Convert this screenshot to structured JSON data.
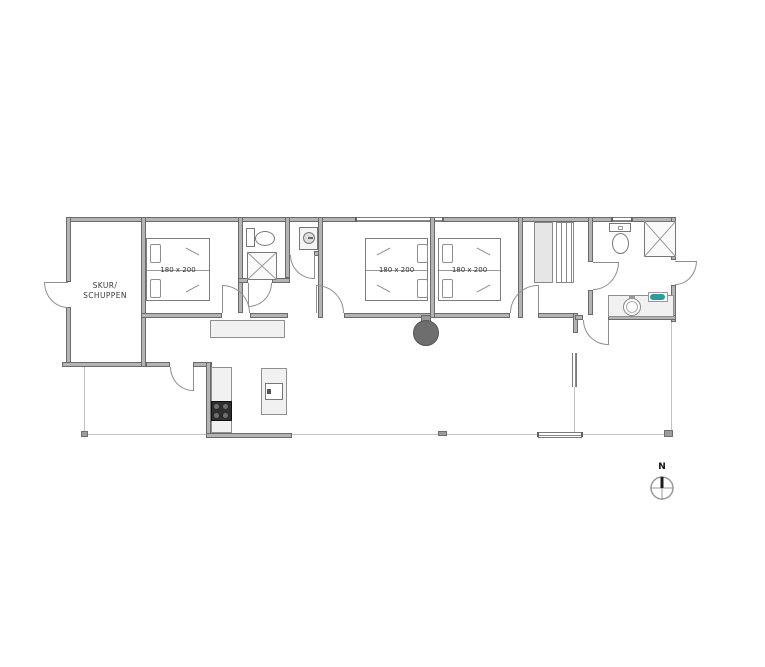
{
  "shed": {
    "label_line1": "SKUR/",
    "label_line2": "SCHUPPEN"
  },
  "bedrooms": [
    {
      "bed_label": "180 x 200"
    },
    {
      "bed_label": "180 x 200"
    },
    {
      "bed_label": "180 x 200"
    }
  ],
  "compass": {
    "north_label": "N"
  },
  "colors": {
    "wall_fill": "#b4b4b4",
    "wall_edge": "#6a6a6a",
    "furniture_fill": "#f1f1f1",
    "furniture_edge": "#8f8f8f",
    "appliance_dark": "#2e2e2e",
    "wood_stove": "#6e6e6e",
    "sink_teal": "#2e9c9c",
    "terrace_line": "#c2c2c2"
  }
}
